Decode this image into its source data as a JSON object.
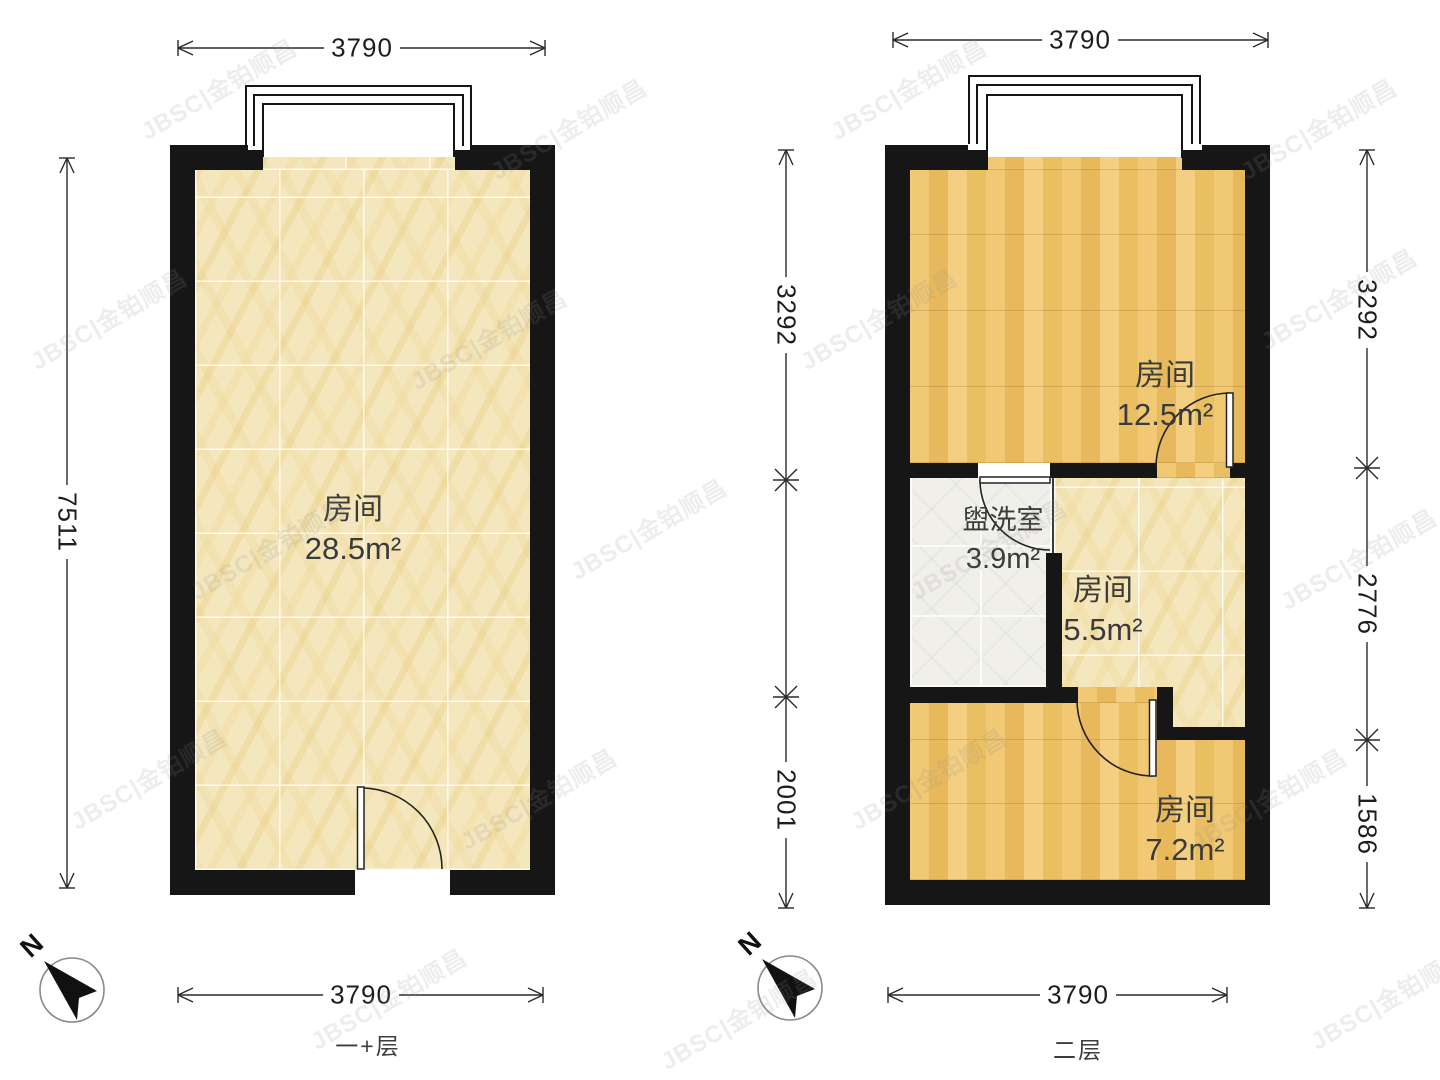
{
  "watermark": "JBSC|金铂顺昌",
  "compass_label": "N",
  "colors": {
    "wall": "#161616",
    "wood_floor": "#eec167",
    "tile_floor": "#f4e7bd",
    "washroom_floor": "#f0efea",
    "dimension_line": "#2a2a2a"
  },
  "floor1": {
    "name": "一+层",
    "dim_top": "3790",
    "dim_left": "7511",
    "dim_bottom": "3790",
    "room": {
      "label": "房间",
      "area": "28.5m²"
    }
  },
  "floor2": {
    "name": "二层",
    "dim_top": "3790",
    "dim_bottom": "3790",
    "dim_left_upper": "3292",
    "dim_left_lower": "2001",
    "dim_right_upper": "3292",
    "dim_right_middle": "2776",
    "dim_right_lower": "1586",
    "rooms": {
      "bedroom_top": {
        "label": "房间",
        "area": "12.5m²"
      },
      "washroom": {
        "label": "盥洗室",
        "area": "3.9m²"
      },
      "room_middle": {
        "label": "房间",
        "area": "5.5m²"
      },
      "room_bottom": {
        "label": "房间",
        "area": "7.2m²"
      }
    }
  }
}
